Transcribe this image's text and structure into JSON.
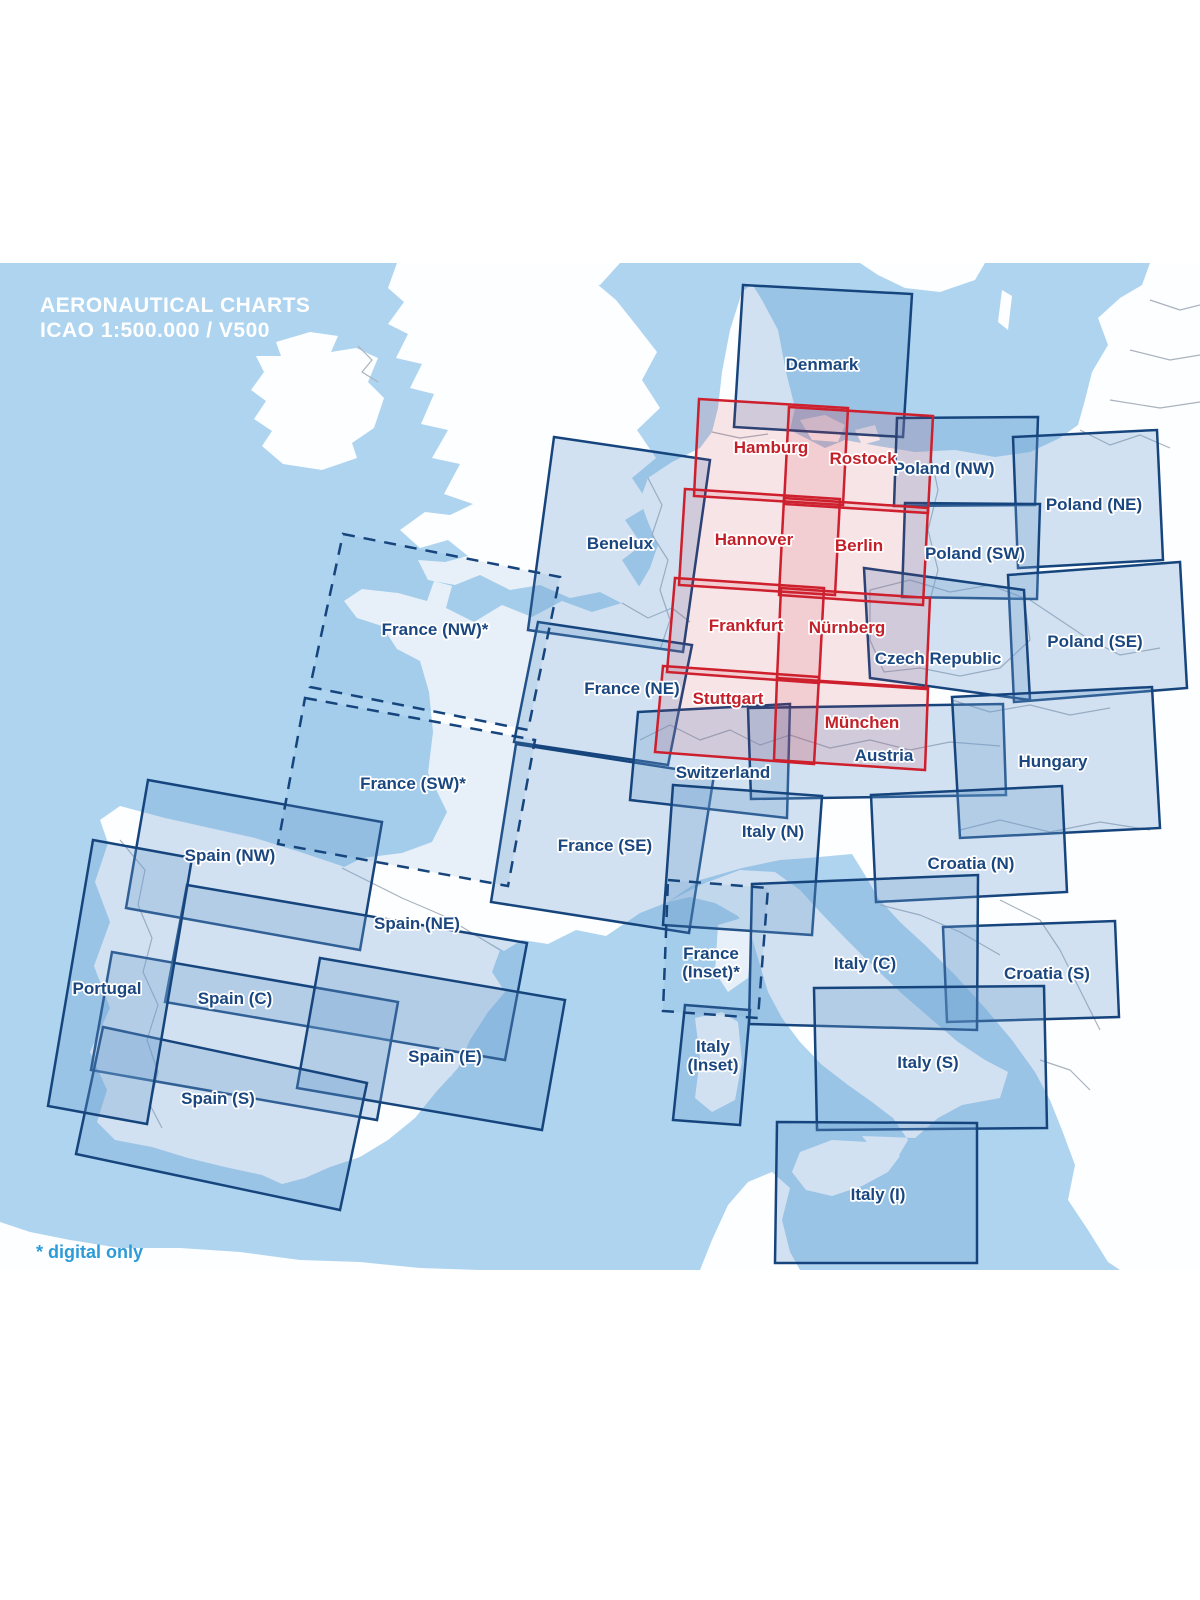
{
  "title": {
    "line1": "AERONAUTICAL CHARTS",
    "line2": "ICAO 1:500.000 / V500"
  },
  "footnote": "* digital only",
  "colors": {
    "sea": "#AED4F0",
    "land": "#FDFEFF",
    "border": "#A9B3BE",
    "blue_stroke": "#16457D",
    "blue_fill": "rgba(110,160,210,0.30)",
    "dashed_fill": "rgba(110,160,210,0.15)",
    "red_stroke": "#CE1F2D",
    "red_fill": "rgba(205,40,55,0.12)",
    "blue_label": "#1A4780",
    "red_label": "#C4202A",
    "title_color": "#FFFFFF",
    "footnote_color": "#2D9BD8"
  },
  "map": {
    "top": 263,
    "bottom": 1270,
    "land_paths": [
      "M310,332 L338,336 L331,352 L356,348 L378,358 L368,382 L384,398 L374,428 L352,443 L357,458 L322,470 L283,464 L262,446 L272,431 L254,419 L266,401 L251,390 L264,372 L256,356 L281,356 L276,342 Z",
      "M397,263 L388,288 L404,302 L388,324 L408,334 L396,358 L422,364 L410,388 L434,394 L421,424 L448,430 L432,458 L460,464 L444,494 L473,504 L450,515 L425,512 L400,530 L420,548 L448,540 L468,556 L445,562 L418,560 L428,580 L455,585 L480,575 L510,590 L540,585 L570,598 L600,592 L625,605 L640,588 L622,560 L642,545 L625,520 L650,505 L632,478 L656,458 L637,430 L660,408 L642,380 L657,352 L636,325 L616,300 L590,278 L575,263 Z",
      "M622,603 L592,612 L562,601 L532,617 L502,605 L474,622 L446,608 L452,586 L434,581 L427,601 L398,593 L362,589 L344,601 L357,618 L382,626 L397,649 L420,661 L429,692 L433,732 L428,773 L447,812 L432,842 L402,853 L362,858 L342,868 L402,898 L444,916 L472,933 L504,951 L522,940 L548,944 L576,930 L606,936 L640,913 L668,902 L700,880 L742,868 L780,860 L808,858 L852,854 L865,875 L878,898 L900,922 L925,945 L955,975 L985,1008 L1012,1040 L1035,1072 L1050,1100 L1062,1130 L1075,1165 L1068,1200 L1088,1230 L1108,1262 L1120,1270 L1200,1270 L1200,263 L1150,263 L1142,285 L1120,298 L1098,318 L1108,345 L1092,372 L1085,400 L1078,425 L1060,438 L1030,452 L995,457 L955,450 L915,452 L878,446 L845,440 L825,448 L790,430 L795,408 L786,372 L778,330 L762,300 L752,284 L742,292 L730,330 L722,372 L718,408 L712,432 L700,448 L672,462 L648,478 L640,500 L648,522 L658,545 L650,568 L640,585 L630,596 Z",
      "M120,806 L165,818 L210,828 L255,838 L300,852 L342,866 L402,898 L444,916 L472,933 L500,950 L492,972 L505,992 L488,1012 L470,1040 L458,1068 L436,1092 L415,1118 L388,1140 L360,1157 L330,1167 L305,1178 L282,1184 L262,1175 L225,1167 L188,1158 L152,1147 L115,1140 L97,1122 L107,1090 L90,1052 L110,1008 L94,966 L110,922 L95,882 L108,843 L100,820 Z",
      "M668,902 L690,897 L715,903 L738,916 L752,938 L760,965 L768,992 L782,1018 L800,1042 L822,1065 L848,1085 L872,1102 L893,1118 L908,1140 L895,1162 L880,1158 L862,1136 L915,1138 L938,1118 L962,1105 L1000,1098 L1008,1072 L985,1060 L958,1042 L930,1018 L900,992 L872,965 L845,938 L820,912 L800,890 L775,872 L740,870 L700,885 Z",
      "M800,1152 L832,1140 L868,1142 L900,1156 L888,1172 L862,1186 L832,1196 L806,1190 L792,1172 Z",
      "M695,1018 L722,1012 L738,1022 L742,1062 L735,1100 L712,1112 L695,1098 L700,1058 Z",
      "M718,925 L742,918 L752,938 L748,978 L728,992 L715,972 Z",
      "M368,1092 L398,1080 L428,1086 L415,1102 L385,1104 Z",
      "M340,1108 L356,1100 L362,1112 L348,1118 Z",
      "M432,1072 L448,1066 L452,1076 L438,1080 Z",
      "M800,420 L825,415 L845,425 L838,442 L812,440 Z",
      "M855,430 L875,425 L880,440 L862,445 Z",
      "M860,263 L985,263 L975,280 L940,292 L905,288 L878,275 Z",
      "M1002,290 L1012,296 L1008,330 L998,322 Z",
      "M540,263 L620,263 L600,285 L565,280 Z",
      "M0,1222 L30,1232 L70,1240 L120,1248 L180,1248 L240,1252 L300,1260 L360,1262 L420,1268 L480,1270 L0,1270 Z",
      "M700,1270 L712,1240 L728,1205 L748,1182 L772,1172 L790,1188 L782,1220 L790,1252 L800,1270 Z"
    ],
    "border_paths": [
      "M120,840 L145,870 L138,905 L152,938 L143,972 L158,1005 L147,1040 L158,1072 L150,1105 L162,1128",
      "M342,868 L402,898 L444,916 L472,933 L500,950",
      "M358,346 L372,360 L362,372 L378,382",
      "M648,478 L662,505 L652,535 L668,560 L660,590 L670,620 L660,650",
      "M622,603 L648,618 L672,608 L690,622",
      "M712,432 L740,438 L768,434",
      "M930,452 L938,490 L928,530 L938,570 L930,600",
      "M870,590 L910,580 L950,592 L990,585 L1024,598 L1030,640 L1000,668 L960,676 L920,668 L884,672 L870,640 Z",
      "M640,740 L670,725 L700,740 L730,730 L760,745 L790,735",
      "M790,735 L830,748 L870,740 L910,750 L950,742 L1000,746",
      "M952,700 L990,712 L1030,705 L1070,715 L1110,708",
      "M960,830 L1000,820 L1050,832 L1100,822 L1150,830",
      "M880,905 L920,915 L960,932 L1000,955",
      "M1000,900 L1040,920 L1060,950 L1080,990 L1100,1030",
      "M1080,430 L1110,445 L1140,435 L1170,448",
      "M1150,300 L1180,310 L1200,305",
      "M1130,350 L1170,360 L1200,355",
      "M1110,400 L1160,408 L1200,402",
      "M1030,600 L1060,620 L1090,640 L1120,655 L1160,648",
      "M1040,1060 L1070,1070 L1090,1090"
    ]
  },
  "boxes": [
    {
      "id": "denmark",
      "type": "blue",
      "label_lines": [
        "Denmark"
      ],
      "label_pos": [
        822,
        364
      ],
      "points": [
        [
          743,
          285
        ],
        [
          912,
          294
        ],
        [
          903,
          437
        ],
        [
          734,
          427
        ]
      ]
    },
    {
      "id": "poland-nw",
      "type": "blue",
      "label_lines": [
        "Poland (NW)"
      ],
      "label_pos": [
        944,
        468
      ],
      "points": [
        [
          897,
          418
        ],
        [
          1038,
          417
        ],
        [
          1035,
          505
        ],
        [
          894,
          506
        ]
      ]
    },
    {
      "id": "poland-ne",
      "type": "blue",
      "label_lines": [
        "Poland (NE)"
      ],
      "label_pos": [
        1094,
        504
      ],
      "points": [
        [
          1013,
          437
        ],
        [
          1157,
          430
        ],
        [
          1163,
          560
        ],
        [
          1018,
          568
        ]
      ]
    },
    {
      "id": "poland-sw",
      "type": "blue",
      "label_lines": [
        "Poland (SW)"
      ],
      "label_pos": [
        975,
        553
      ],
      "points": [
        [
          905,
          503
        ],
        [
          1040,
          504
        ],
        [
          1037,
          599
        ],
        [
          902,
          597
        ]
      ]
    },
    {
      "id": "poland-se",
      "type": "blue",
      "label_lines": [
        "Poland (SE)"
      ],
      "label_pos": [
        1095,
        641
      ],
      "points": [
        [
          1008,
          575
        ],
        [
          1180,
          562
        ],
        [
          1187,
          688
        ],
        [
          1014,
          702
        ]
      ]
    },
    {
      "id": "czech-republic",
      "type": "blue",
      "label_lines": [
        "Czech Republic"
      ],
      "label_pos": [
        938,
        658
      ],
      "points": [
        [
          864,
          568
        ],
        [
          1024,
          590
        ],
        [
          1030,
          700
        ],
        [
          870,
          678
        ]
      ]
    },
    {
      "id": "benelux",
      "type": "blue",
      "label_lines": [
        "Benelux"
      ],
      "label_pos": [
        620,
        543
      ],
      "points": [
        [
          554,
          437
        ],
        [
          710,
          460
        ],
        [
          683,
          652
        ],
        [
          528,
          630
        ]
      ]
    },
    {
      "id": "france-ne",
      "type": "blue",
      "label_lines": [
        "France (NE)"
      ],
      "label_pos": [
        632,
        688
      ],
      "points": [
        [
          538,
          622
        ],
        [
          692,
          645
        ],
        [
          668,
          765
        ],
        [
          514,
          742
        ]
      ]
    },
    {
      "id": "france-se",
      "type": "blue",
      "label_lines": [
        "France (SE)"
      ],
      "label_pos": [
        605,
        845
      ],
      "points": [
        [
          516,
          744
        ],
        [
          714,
          775
        ],
        [
          689,
          933
        ],
        [
          491,
          902
        ]
      ]
    },
    {
      "id": "switzerland",
      "type": "blue",
      "label_lines": [
        "Switzerland"
      ],
      "label_pos": [
        723,
        772
      ],
      "points": [
        [
          638,
          712
        ],
        [
          790,
          704
        ],
        [
          787,
          818
        ],
        [
          630,
          800
        ]
      ]
    },
    {
      "id": "austria",
      "type": "blue",
      "label_lines": [
        "Austria"
      ],
      "label_pos": [
        884,
        755
      ],
      "points": [
        [
          748,
          708
        ],
        [
          1003,
          704
        ],
        [
          1006,
          795
        ],
        [
          751,
          799
        ]
      ]
    },
    {
      "id": "hungary",
      "type": "blue",
      "label_lines": [
        "Hungary"
      ],
      "label_pos": [
        1053,
        761
      ],
      "points": [
        [
          952,
          697
        ],
        [
          1152,
          687
        ],
        [
          1160,
          828
        ],
        [
          960,
          838
        ]
      ]
    },
    {
      "id": "italy-n",
      "type": "blue",
      "label_lines": [
        "Italy (N)"
      ],
      "label_pos": [
        773,
        831
      ],
      "points": [
        [
          673,
          785
        ],
        [
          822,
          796
        ],
        [
          812,
          935
        ],
        [
          663,
          925
        ]
      ]
    },
    {
      "id": "croatia-n",
      "type": "blue",
      "label_lines": [
        "Croatia (N)"
      ],
      "label_pos": [
        971,
        863
      ],
      "points": [
        [
          871,
          795
        ],
        [
          1062,
          786
        ],
        [
          1067,
          892
        ],
        [
          876,
          902
        ]
      ]
    },
    {
      "id": "croatia-s",
      "type": "blue",
      "label_lines": [
        "Croatia (S)"
      ],
      "label_pos": [
        1047,
        973
      ],
      "points": [
        [
          943,
          927
        ],
        [
          1115,
          921
        ],
        [
          1119,
          1017
        ],
        [
          947,
          1022
        ]
      ]
    },
    {
      "id": "italy-c",
      "type": "blue",
      "label_lines": [
        "Italy (C)"
      ],
      "label_pos": [
        865,
        963
      ],
      "points": [
        [
          752,
          884
        ],
        [
          978,
          875
        ],
        [
          977,
          1030
        ],
        [
          749,
          1024
        ]
      ]
    },
    {
      "id": "italy-s",
      "type": "blue",
      "label_lines": [
        "Italy (S)"
      ],
      "label_pos": [
        928,
        1062
      ],
      "points": [
        [
          814,
          988
        ],
        [
          1044,
          986
        ],
        [
          1047,
          1128
        ],
        [
          817,
          1130
        ]
      ]
    },
    {
      "id": "italy-i",
      "type": "blue",
      "label_lines": [
        "Italy (I)"
      ],
      "label_pos": [
        878,
        1194
      ],
      "points": [
        [
          777,
          1122
        ],
        [
          977,
          1123
        ],
        [
          977,
          1263
        ],
        [
          775,
          1263
        ]
      ]
    },
    {
      "id": "italy-inset",
      "type": "blue",
      "label_lines": [
        "Italy",
        "(Inset)"
      ],
      "label_pos": [
        713,
        1046
      ],
      "points": [
        [
          685,
          1005
        ],
        [
          750,
          1010
        ],
        [
          740,
          1125
        ],
        [
          673,
          1120
        ]
      ]
    },
    {
      "id": "spain-nw",
      "type": "blue",
      "label_lines": [
        "Spain (NW)"
      ],
      "label_pos": [
        230,
        855
      ],
      "points": [
        [
          148,
          780
        ],
        [
          382,
          822
        ],
        [
          360,
          950
        ],
        [
          126,
          908
        ]
      ]
    },
    {
      "id": "spain-ne",
      "type": "blue",
      "label_lines": [
        "Spain (NE)"
      ],
      "label_pos": [
        417,
        923
      ],
      "points": [
        [
          187,
          885
        ],
        [
          527,
          943
        ],
        [
          505,
          1060
        ],
        [
          165,
          1002
        ]
      ]
    },
    {
      "id": "spain-c",
      "type": "blue",
      "label_lines": [
        "Spain (C)"
      ],
      "label_pos": [
        235,
        998
      ],
      "points": [
        [
          112,
          952
        ],
        [
          398,
          1002
        ],
        [
          377,
          1120
        ],
        [
          91,
          1070
        ]
      ]
    },
    {
      "id": "spain-e",
      "type": "blue",
      "label_lines": [
        "Spain (E)"
      ],
      "label_pos": [
        445,
        1056
      ],
      "points": [
        [
          320,
          958
        ],
        [
          565,
          1000
        ],
        [
          542,
          1130
        ],
        [
          297,
          1088
        ]
      ]
    },
    {
      "id": "spain-s",
      "type": "blue",
      "label_lines": [
        "Spain (S)"
      ],
      "label_pos": [
        218,
        1098
      ],
      "points": [
        [
          103,
          1027
        ],
        [
          367,
          1083
        ],
        [
          340,
          1210
        ],
        [
          76,
          1154
        ]
      ]
    },
    {
      "id": "portugal",
      "type": "blue",
      "label_lines": [
        "Portugal"
      ],
      "label_pos": [
        107,
        988
      ],
      "points": [
        [
          93,
          840
        ],
        [
          192,
          858
        ],
        [
          147,
          1124
        ],
        [
          48,
          1106
        ]
      ]
    },
    {
      "id": "france-nw",
      "type": "dashed",
      "label_lines": [
        "France (NW)*"
      ],
      "label_pos": [
        435,
        629
      ],
      "points": [
        [
          343,
          534
        ],
        [
          560,
          577
        ],
        [
          528,
          730
        ],
        [
          310,
          687
        ]
      ]
    },
    {
      "id": "france-sw",
      "type": "dashed",
      "label_lines": [
        "France (SW)*"
      ],
      "label_pos": [
        413,
        783
      ],
      "points": [
        [
          305,
          698
        ],
        [
          535,
          740
        ],
        [
          508,
          886
        ],
        [
          278,
          844
        ]
      ]
    },
    {
      "id": "france-inset",
      "type": "dashed",
      "label_lines": [
        "France",
        "(Inset)*"
      ],
      "label_pos": [
        711,
        953
      ],
      "points": [
        [
          668,
          880
        ],
        [
          768,
          888
        ],
        [
          758,
          1018
        ],
        [
          663,
          1011
        ]
      ]
    },
    {
      "id": "hamburg",
      "type": "red",
      "label_lines": [
        "Hamburg"
      ],
      "label_pos": [
        771,
        447
      ],
      "points": [
        [
          699,
          399
        ],
        [
          848,
          408
        ],
        [
          843,
          505
        ],
        [
          694,
          496
        ]
      ]
    },
    {
      "id": "rostock",
      "type": "red",
      "label_lines": [
        "Rostock"
      ],
      "label_pos": [
        863,
        458
      ],
      "points": [
        [
          789,
          407
        ],
        [
          933,
          416
        ],
        [
          928,
          513
        ],
        [
          784,
          504
        ]
      ]
    },
    {
      "id": "hannover",
      "type": "red",
      "label_lines": [
        "Hannover"
      ],
      "label_pos": [
        754,
        539
      ],
      "points": [
        [
          685,
          489
        ],
        [
          840,
          499
        ],
        [
          835,
          595
        ],
        [
          679,
          585
        ]
      ]
    },
    {
      "id": "berlin",
      "type": "red",
      "label_lines": [
        "Berlin"
      ],
      "label_pos": [
        859,
        545
      ],
      "points": [
        [
          784,
          498
        ],
        [
          928,
          508
        ],
        [
          923,
          605
        ],
        [
          779,
          595
        ]
      ]
    },
    {
      "id": "frankfurt",
      "type": "red",
      "label_lines": [
        "Frankfurt"
      ],
      "label_pos": [
        746,
        625
      ],
      "points": [
        [
          675,
          578
        ],
        [
          824,
          588
        ],
        [
          819,
          683
        ],
        [
          667,
          672
        ]
      ]
    },
    {
      "id": "nurnberg",
      "type": "red",
      "label_lines": [
        "Nürnberg"
      ],
      "label_pos": [
        847,
        627
      ],
      "points": [
        [
          781,
          588
        ],
        [
          930,
          598
        ],
        [
          926,
          689
        ],
        [
          777,
          679
        ]
      ]
    },
    {
      "id": "stuttgart",
      "type": "red",
      "label_lines": [
        "Stuttgart"
      ],
      "label_pos": [
        728,
        698
      ],
      "points": [
        [
          663,
          666
        ],
        [
          819,
          677
        ],
        [
          814,
          764
        ],
        [
          655,
          752
        ]
      ]
    },
    {
      "id": "munchen",
      "type": "red",
      "label_lines": [
        "München"
      ],
      "label_pos": [
        862,
        722
      ],
      "points": [
        [
          777,
          678
        ],
        [
          928,
          688
        ],
        [
          925,
          770
        ],
        [
          774,
          760
        ]
      ]
    }
  ]
}
